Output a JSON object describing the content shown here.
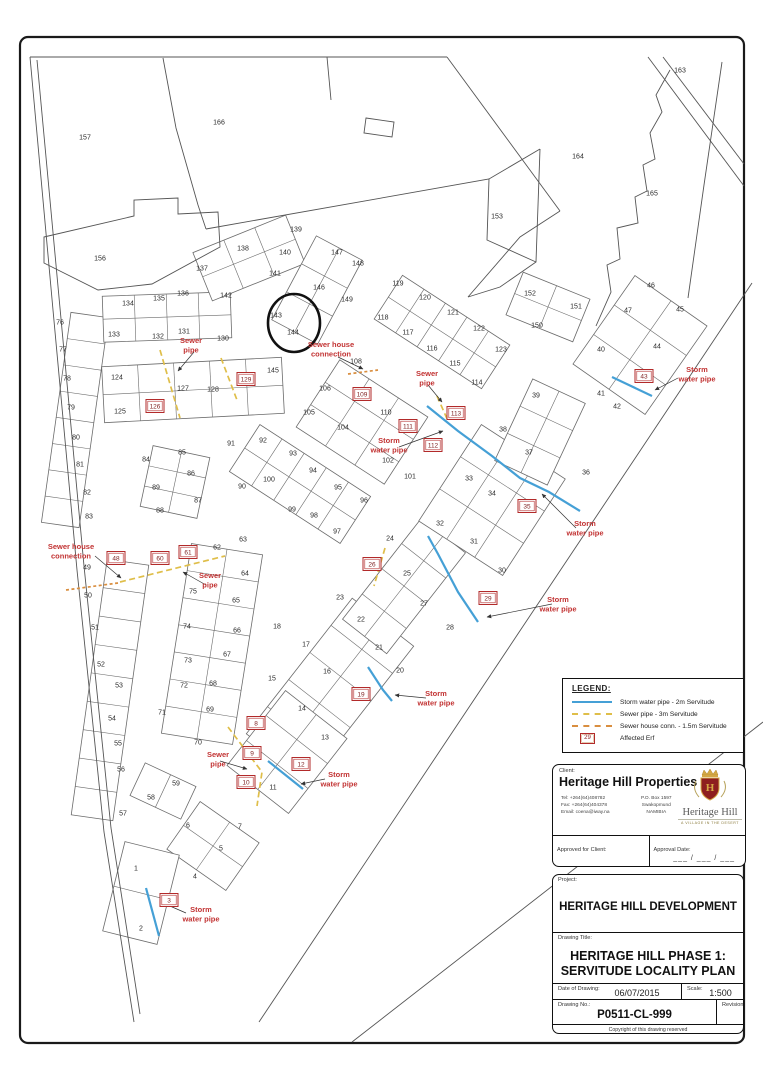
{
  "colors": {
    "storm_pipe": "#45a0d6",
    "sewer_pipe": "#dfbe49",
    "house_conn": "#d98e3f",
    "affected_red": "#b22a2a",
    "annotation_red": "#c23333",
    "boundary": "#555555"
  },
  "legend": {
    "title": "LEGEND:",
    "items": [
      {
        "symbol": "storm-line",
        "label": "Storm water pipe - 2m Servitude"
      },
      {
        "symbol": "sewer-line",
        "label": "Sewer pipe - 3m Servitude"
      },
      {
        "symbol": "house-conn-line",
        "label": "Sewer house conn. - 1.5m Servitude"
      },
      {
        "symbol": "erf-box",
        "box_number": "29",
        "label": "Affected Erf"
      }
    ]
  },
  "client_block": {
    "label": "Client:",
    "name": "Heritage Hill Properties",
    "tel": "Tel: +264(64)408782",
    "fax": "Fax: +264(64)404378",
    "email": "Email: coena@iway.na",
    "po_box": "P.O. Box 1597",
    "city": "Swakopmund",
    "country": "NAMIBIA",
    "approved_label": "Approved for Client:",
    "approval_date_label": "Approval Date:",
    "approval_date_value": "___ / ___ / ___",
    "logo_text": "Heritage Hill",
    "logo_tagline": "A VILLAGE IN THE DESERT"
  },
  "title_block": {
    "project_label": "Project:",
    "project": "HERITAGE HILL DEVELOPMENT",
    "drawing_title_label": "Drawing Title:",
    "drawing_title_1": "HERITAGE HILL PHASE 1:",
    "drawing_title_2": "SERVITUDE LOCALITY PLAN",
    "date_label": "Date of Drawing:",
    "date": "06/07/2015",
    "scale_label": "Scale:",
    "scale": "1:500",
    "drawing_no_label": "Drawing No.:",
    "drawing_no": "P0511-CL-999",
    "revision_label": "Revision:",
    "copyright": "Copyright of this drawing reserved"
  },
  "plan": {
    "plots": [
      [
        1,
        136,
        868
      ],
      [
        2,
        141,
        928
      ],
      [
        4,
        195,
        876
      ],
      [
        5,
        221,
        848
      ],
      [
        6,
        188,
        825
      ],
      [
        7,
        240,
        826
      ],
      [
        11,
        273,
        787
      ],
      [
        13,
        325,
        737
      ],
      [
        14,
        302,
        708
      ],
      [
        15,
        272,
        678
      ],
      [
        16,
        327,
        671
      ],
      [
        17,
        306,
        644
      ],
      [
        18,
        277,
        626
      ],
      [
        20,
        400,
        670
      ],
      [
        21,
        379,
        647
      ],
      [
        22,
        361,
        619
      ],
      [
        23,
        340,
        597
      ],
      [
        24,
        390,
        538
      ],
      [
        25,
        407,
        573
      ],
      [
        27,
        424,
        603
      ],
      [
        28,
        450,
        627
      ],
      [
        30,
        502,
        570
      ],
      [
        31,
        474,
        541
      ],
      [
        32,
        440,
        523
      ],
      [
        33,
        469,
        478
      ],
      [
        34,
        492,
        493
      ],
      [
        36,
        586,
        472
      ],
      [
        37,
        529,
        452
      ],
      [
        38,
        503,
        429
      ],
      [
        39,
        536,
        395
      ],
      [
        40,
        601,
        349
      ],
      [
        41,
        601,
        393
      ],
      [
        42,
        617,
        406
      ],
      [
        44,
        657,
        346
      ],
      [
        45,
        680,
        309
      ],
      [
        46,
        651,
        285
      ],
      [
        47,
        628,
        310
      ],
      [
        49,
        87,
        567
      ],
      [
        50,
        88,
        595
      ],
      [
        51,
        95,
        627
      ],
      [
        52,
        101,
        664
      ],
      [
        53,
        119,
        685
      ],
      [
        54,
        112,
        718
      ],
      [
        55,
        118,
        743
      ],
      [
        56,
        121,
        769
      ],
      [
        57,
        123,
        813
      ],
      [
        58,
        151,
        797
      ],
      [
        59,
        176,
        783
      ],
      [
        62,
        217,
        547
      ],
      [
        63,
        243,
        539
      ],
      [
        64,
        245,
        573
      ],
      [
        65,
        236,
        600
      ],
      [
        66,
        237,
        630
      ],
      [
        67,
        227,
        654
      ],
      [
        68,
        213,
        683
      ],
      [
        69,
        210,
        709
      ],
      [
        70,
        198,
        742
      ],
      [
        71,
        162,
        712
      ],
      [
        72,
        184,
        685
      ],
      [
        73,
        188,
        660
      ],
      [
        74,
        187,
        626
      ],
      [
        75,
        193,
        591
      ],
      [
        76,
        60,
        322
      ],
      [
        77,
        63,
        349
      ],
      [
        78,
        67,
        378
      ],
      [
        79,
        71,
        407
      ],
      [
        80,
        76,
        437
      ],
      [
        81,
        80,
        464
      ],
      [
        82,
        87,
        492
      ],
      [
        83,
        89,
        516
      ],
      [
        84,
        146,
        459
      ],
      [
        85,
        182,
        452
      ],
      [
        86,
        191,
        473
      ],
      [
        87,
        198,
        500
      ],
      [
        88,
        160,
        510
      ],
      [
        89,
        156,
        487
      ],
      [
        90,
        242,
        486
      ],
      [
        91,
        231,
        443
      ],
      [
        92,
        263,
        440
      ],
      [
        93,
        293,
        453
      ],
      [
        94,
        313,
        470
      ],
      [
        95,
        338,
        487
      ],
      [
        96,
        364,
        500
      ],
      [
        97,
        337,
        531
      ],
      [
        98,
        314,
        515
      ],
      [
        99,
        292,
        509
      ],
      [
        100,
        269,
        479
      ],
      [
        101,
        410,
        476
      ],
      [
        102,
        388,
        460
      ],
      [
        104,
        343,
        427
      ],
      [
        105,
        309,
        412
      ],
      [
        106,
        325,
        388
      ],
      [
        108,
        356,
        361
      ],
      [
        110,
        386,
        412
      ],
      [
        114,
        477,
        382
      ],
      [
        115,
        455,
        363
      ],
      [
        116,
        432,
        348
      ],
      [
        117,
        408,
        332
      ],
      [
        118,
        383,
        317
      ],
      [
        119,
        398,
        283
      ],
      [
        120,
        425,
        297
      ],
      [
        121,
        453,
        312
      ],
      [
        122,
        479,
        328
      ],
      [
        123,
        501,
        349
      ],
      [
        124,
        117,
        377
      ],
      [
        125,
        120,
        411
      ],
      [
        127,
        183,
        388
      ],
      [
        128,
        213,
        389
      ],
      [
        130,
        223,
        338
      ],
      [
        131,
        184,
        331
      ],
      [
        132,
        158,
        336
      ],
      [
        133,
        114,
        334
      ],
      [
        134,
        128,
        303
      ],
      [
        135,
        159,
        298
      ],
      [
        136,
        183,
        293
      ],
      [
        137,
        202,
        268
      ],
      [
        138,
        243,
        248
      ],
      [
        139,
        296,
        229
      ],
      [
        140,
        285,
        252
      ],
      [
        141,
        275,
        273
      ],
      [
        142,
        226,
        295
      ],
      [
        143,
        276,
        315
      ],
      [
        144,
        293,
        332
      ],
      [
        145,
        273,
        370
      ],
      [
        146,
        319,
        287
      ],
      [
        147,
        337,
        252
      ],
      [
        148,
        358,
        263
      ],
      [
        149,
        347,
        299
      ],
      [
        150,
        537,
        325
      ],
      [
        151,
        576,
        306
      ],
      [
        152,
        530,
        293
      ],
      [
        153,
        497,
        216
      ],
      [
        156,
        100,
        258
      ],
      [
        157,
        85,
        137
      ],
      [
        163,
        680,
        70
      ],
      [
        164,
        578,
        156
      ],
      [
        165,
        652,
        193
      ],
      [
        166,
        219,
        122
      ]
    ],
    "affected_erven": [
      [
        3,
        169,
        900
      ],
      [
        8,
        256,
        723
      ],
      [
        9,
        252,
        753
      ],
      [
        10,
        246,
        782
      ],
      [
        12,
        301,
        764
      ],
      [
        19,
        361,
        694
      ],
      [
        26,
        372,
        564
      ],
      [
        29,
        488,
        598
      ],
      [
        35,
        527,
        506
      ],
      [
        43,
        644,
        376
      ],
      [
        48,
        116,
        558
      ],
      [
        60,
        160,
        558
      ],
      [
        61,
        188,
        552
      ],
      [
        109,
        362,
        394
      ],
      [
        111,
        408,
        426
      ],
      [
        112,
        433,
        445
      ],
      [
        113,
        456,
        413
      ],
      [
        126,
        155,
        406
      ],
      [
        129,
        246,
        379
      ]
    ],
    "annotations": [
      {
        "lines": [
          "Sewer",
          "pipe"
        ],
        "x": 191,
        "y": 343
      },
      {
        "lines": [
          "Sewer house",
          "connection"
        ],
        "x": 331,
        "y": 347
      },
      {
        "lines": [
          "Sewer",
          "pipe"
        ],
        "x": 427,
        "y": 376
      },
      {
        "lines": [
          "Storm",
          "water pipe"
        ],
        "x": 389,
        "y": 443
      },
      {
        "lines": [
          "Storm",
          "water pipe"
        ],
        "x": 697,
        "y": 372
      },
      {
        "lines": [
          "Storm",
          "water pipe"
        ],
        "x": 585,
        "y": 526
      },
      {
        "lines": [
          "Storm",
          "water pipe"
        ],
        "x": 558,
        "y": 602
      },
      {
        "lines": [
          "Storm",
          "water pipe"
        ],
        "x": 436,
        "y": 696
      },
      {
        "lines": [
          "Storm",
          "water pipe"
        ],
        "x": 339,
        "y": 777
      },
      {
        "lines": [
          "Storm",
          "water pipe"
        ],
        "x": 201,
        "y": 912
      },
      {
        "lines": [
          "Sewer",
          "pipe"
        ],
        "x": 210,
        "y": 578
      },
      {
        "lines": [
          "Sewer",
          "pipe"
        ],
        "x": 218,
        "y": 757
      },
      {
        "lines": [
          "Sewer house",
          "connection"
        ],
        "x": 71,
        "y": 549
      }
    ],
    "pipes": {
      "storm": [
        [
          [
            612,
            377
          ],
          [
            652,
            396
          ]
        ],
        [
          [
            427,
            406
          ],
          [
            458,
            431
          ],
          [
            492,
            456
          ],
          [
            520,
            478
          ],
          [
            549,
            492
          ],
          [
            580,
            511
          ]
        ],
        [
          [
            428,
            536
          ],
          [
            438,
            554
          ],
          [
            458,
            592
          ],
          [
            478,
            622
          ]
        ],
        [
          [
            368,
            667
          ],
          [
            383,
            690
          ],
          [
            392,
            701
          ]
        ],
        [
          [
            268,
            761
          ],
          [
            303,
            789
          ]
        ],
        [
          [
            146,
            888
          ],
          [
            159,
            936
          ]
        ]
      ],
      "sewer": [
        [
          [
            160,
            350
          ],
          [
            180,
            418
          ]
        ],
        [
          [
            221,
            358
          ],
          [
            237,
            400
          ]
        ],
        [
          [
            120,
            582
          ],
          [
            225,
            556
          ]
        ],
        [
          [
            228,
            727
          ],
          [
            262,
            772
          ],
          [
            257,
            806
          ]
        ],
        [
          [
            385,
            548
          ],
          [
            374,
            586
          ]
        ],
        [
          [
            437,
            396
          ],
          [
            448,
            421
          ]
        ]
      ],
      "house_conn": [
        [
          [
            66,
            590
          ],
          [
            118,
            583
          ]
        ],
        [
          [
            348,
            374
          ],
          [
            378,
            370
          ]
        ]
      ]
    },
    "leaders": [
      [
        [
          95,
          556
        ],
        [
          121,
          578
        ]
      ],
      [
        [
          338,
          357
        ],
        [
          363,
          369
        ]
      ],
      [
        [
          206,
          585
        ],
        [
          183,
          572
        ]
      ],
      [
        [
          428,
          385
        ],
        [
          442,
          402
        ]
      ],
      [
        [
          194,
          352
        ],
        [
          178,
          371
        ]
      ],
      [
        [
          552,
          604
        ],
        [
          487,
          617
        ]
      ],
      [
        [
          678,
          378
        ],
        [
          655,
          390
        ]
      ],
      [
        [
          576,
          528
        ],
        [
          542,
          494
        ]
      ],
      [
        [
          426,
          698
        ],
        [
          395,
          695
        ]
      ],
      [
        [
          325,
          779
        ],
        [
          301,
          784
        ]
      ],
      [
        [
          186,
          913
        ],
        [
          163,
          903
        ]
      ],
      [
        [
          220,
          761
        ],
        [
          247,
          769
        ]
      ],
      [
        [
          399,
          447
        ],
        [
          443,
          431
        ]
      ]
    ],
    "highlight_circle": {
      "cx": 294,
      "cy": 323,
      "rx": 26,
      "ry": 29
    },
    "blocks": [
      [
        75,
        420,
        38,
        212,
        8,
        8,
        1
      ],
      [
        193,
        390,
        180,
        56,
        -3,
        2,
        5
      ],
      [
        167,
        317,
        128,
        46,
        -2,
        2,
        4
      ],
      [
        249,
        258,
        100,
        52,
        -22,
        2,
        3
      ],
      [
        317,
        290,
        52,
        95,
        28,
        3,
        2
      ],
      [
        442,
        332,
        128,
        52,
        33,
        2,
        5
      ],
      [
        362,
        422,
        105,
        80,
        33,
        3,
        3
      ],
      [
        175,
        482,
        58,
        62,
        12,
        3,
        2
      ],
      [
        300,
        484,
        132,
        56,
        33,
        2,
        5
      ],
      [
        110,
        690,
        42,
        258,
        8,
        9,
        1
      ],
      [
        163,
        791,
        56,
        36,
        25,
        1,
        2
      ],
      [
        212,
        644,
        72,
        192,
        9,
        7,
        2
      ],
      [
        330,
        690,
        78,
        172,
        38,
        5,
        2
      ],
      [
        404,
        586,
        56,
        128,
        38,
        4,
        2
      ],
      [
        492,
        500,
        100,
        115,
        33,
        3,
        3
      ],
      [
        540,
        432,
        58,
        90,
        25,
        3,
        2
      ],
      [
        640,
        345,
        88,
        108,
        35,
        3,
        2
      ],
      [
        548,
        307,
        72,
        46,
        22,
        2,
        2
      ],
      [
        213,
        846,
        72,
        58,
        35,
        2,
        2
      ],
      [
        141,
        893,
        56,
        92,
        14,
        2,
        1
      ],
      [
        287,
        752,
        78,
        95,
        38,
        3,
        2
      ]
    ],
    "outlines": [
      "M30,57 L447,57",
      "M447,57 L560,211",
      "M30,57 L53,310 L77,570 L104,832 L134,1022",
      "M37,60 L60,308 L84,566 L111,828 L140,1014",
      "M752,283 L259,1022",
      "M763,722 L352,1042",
      "M163,58 L176,128 L198,205 L206,229",
      "M206,229 L489,179 L540,149",
      "M540,149 L536,262 L500,287 L468,297",
      "M489,179 L487,240 L536,262",
      "M560,211 L520,237 L468,297",
      "M670,70 L656,95 L662,112 L650,133 L655,159 L643,165 L647,191 L635,197 L638,223 L617,228 L620,259 L607,265 L611,292 L596,326",
      "M722,62 L704,185 L688,298",
      "M648,57 L744,186",
      "M663,57 L744,164",
      "M366,118 L394,122 L392,137 L364,133 Z",
      "M327,57 L331,100",
      "M44,237 L134,216 L134,200 L178,198 L178,214 L218,212 L220,247 L152,284 L98,290 L44,263 Z"
    ]
  }
}
